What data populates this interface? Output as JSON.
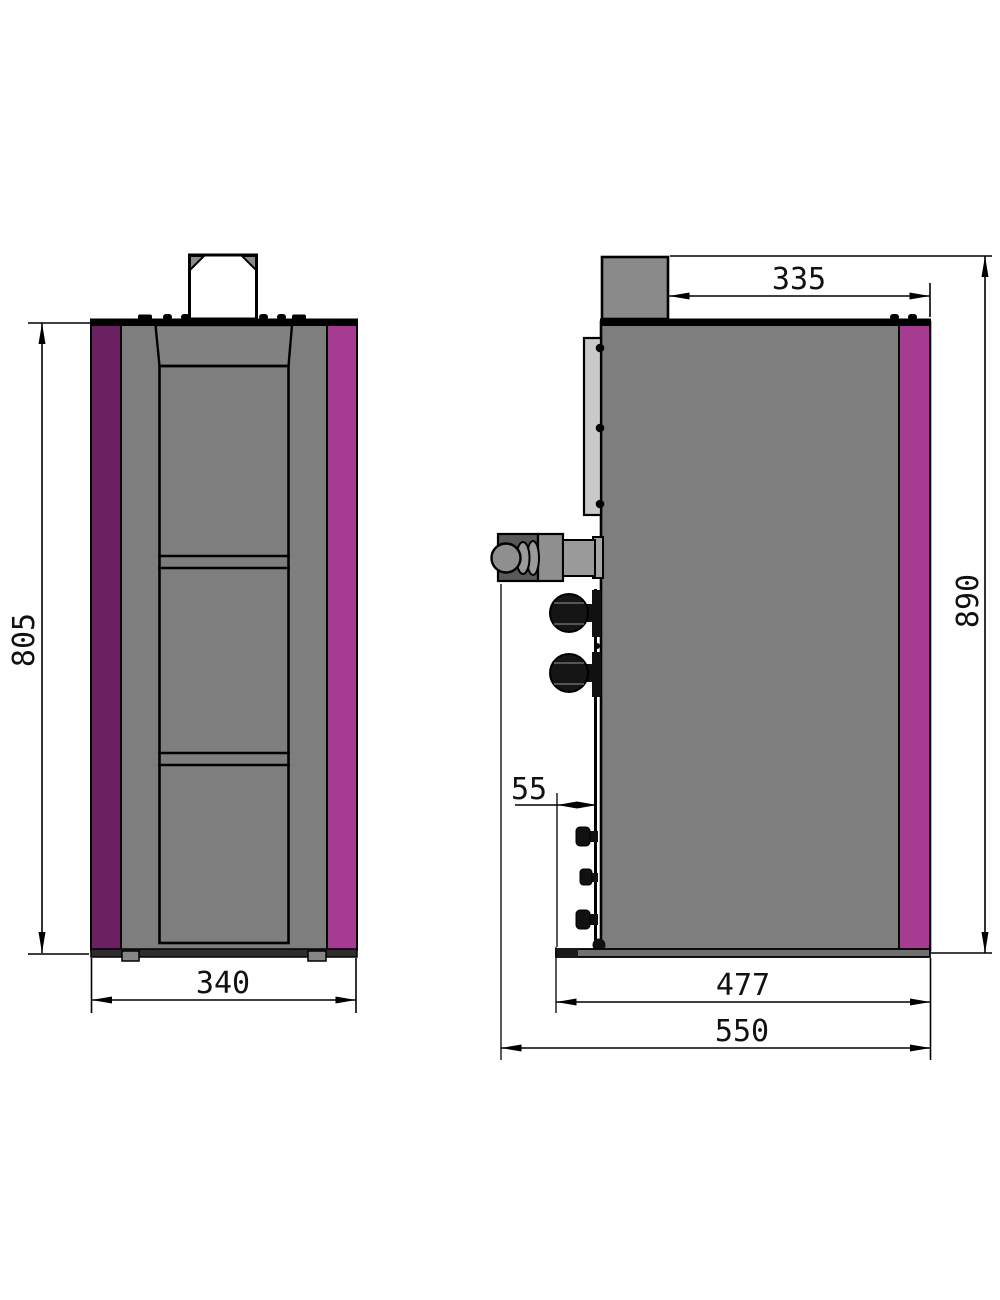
{
  "drawing": {
    "kind": "appliance-dimension-drawing",
    "views": {
      "front": "front-view",
      "side": "side-view"
    },
    "dimensions": {
      "front_height": "805",
      "front_width": "340",
      "flue_to_back": "335",
      "overall_height": "890",
      "front_clearance": "55",
      "base_depth": "477",
      "overall_depth": "550"
    },
    "colors": {
      "body_gray": "#7e7e7e",
      "strip_dark_purple": "#6b2062",
      "strip_magenta": "#a53c92",
      "flue_gray": "#8a8a8a",
      "back_plate_gray": "#c9c9c9",
      "base_dark": "#2e2e2e",
      "connector_dark": "#595959",
      "connector_mid": "#8f8f8f",
      "line_black": "#000000",
      "white": "#ffffff"
    }
  }
}
